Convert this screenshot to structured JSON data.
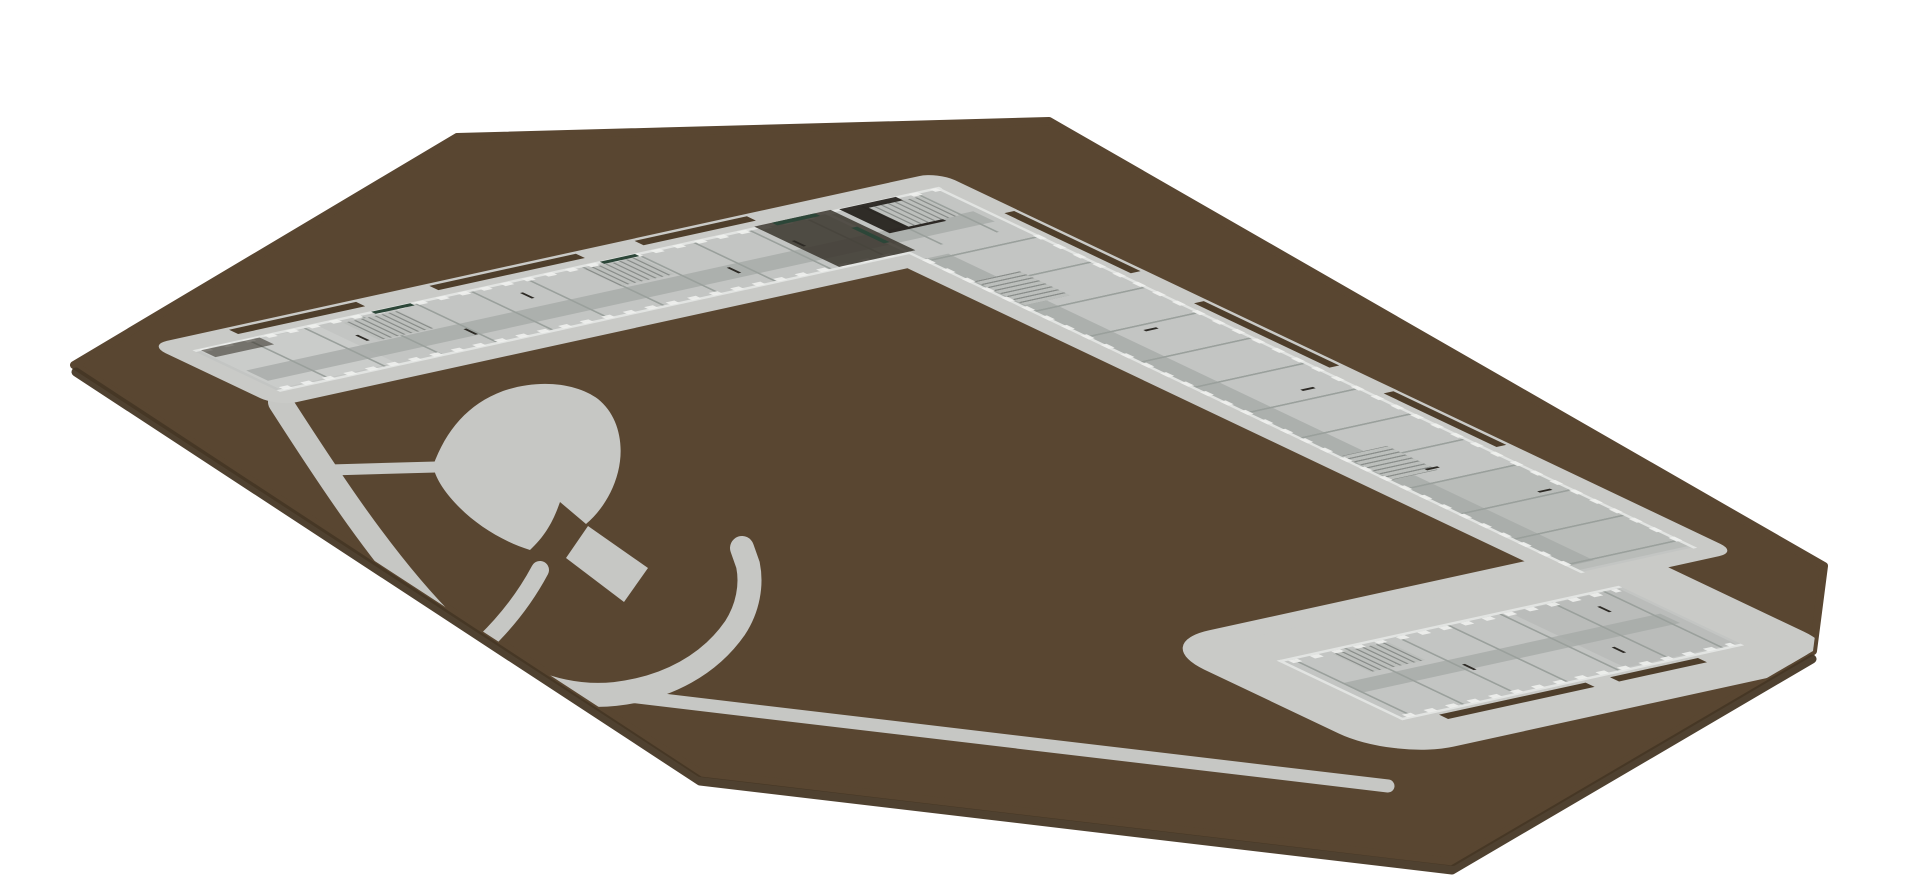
{
  "meta": {
    "view_type": "3d-axonometric-model",
    "description": "Axonometric render of an L-shaped single-storey building model with south-east annex on an irregular brown terrain plot; leaf-shaped landscape feature and garden paths in the courtyard"
  },
  "colors": {
    "background": "#ffffff",
    "site": "#594631",
    "site_edge": "#463725",
    "plinth": "#c9cac7",
    "path_gray": "#c6c7c4",
    "floor": "#c3c5c3",
    "floor_light": "#d0d2d0",
    "floor_dark": "#b1b4b1",
    "corridor": "#a6aaa7",
    "wall_light": "#e2e4e2",
    "wall_mid": "#9aa09c",
    "wall_dark": "#2d2a25",
    "pier": "#f0f1ef",
    "planter": "#4e3e2b",
    "shadow_mid": "#3a352d",
    "shadow_dark": "#1f1b16",
    "window_slit": "#2c4638",
    "stair": "#bcbfbc",
    "stair_rung": "#898d8a"
  }
}
